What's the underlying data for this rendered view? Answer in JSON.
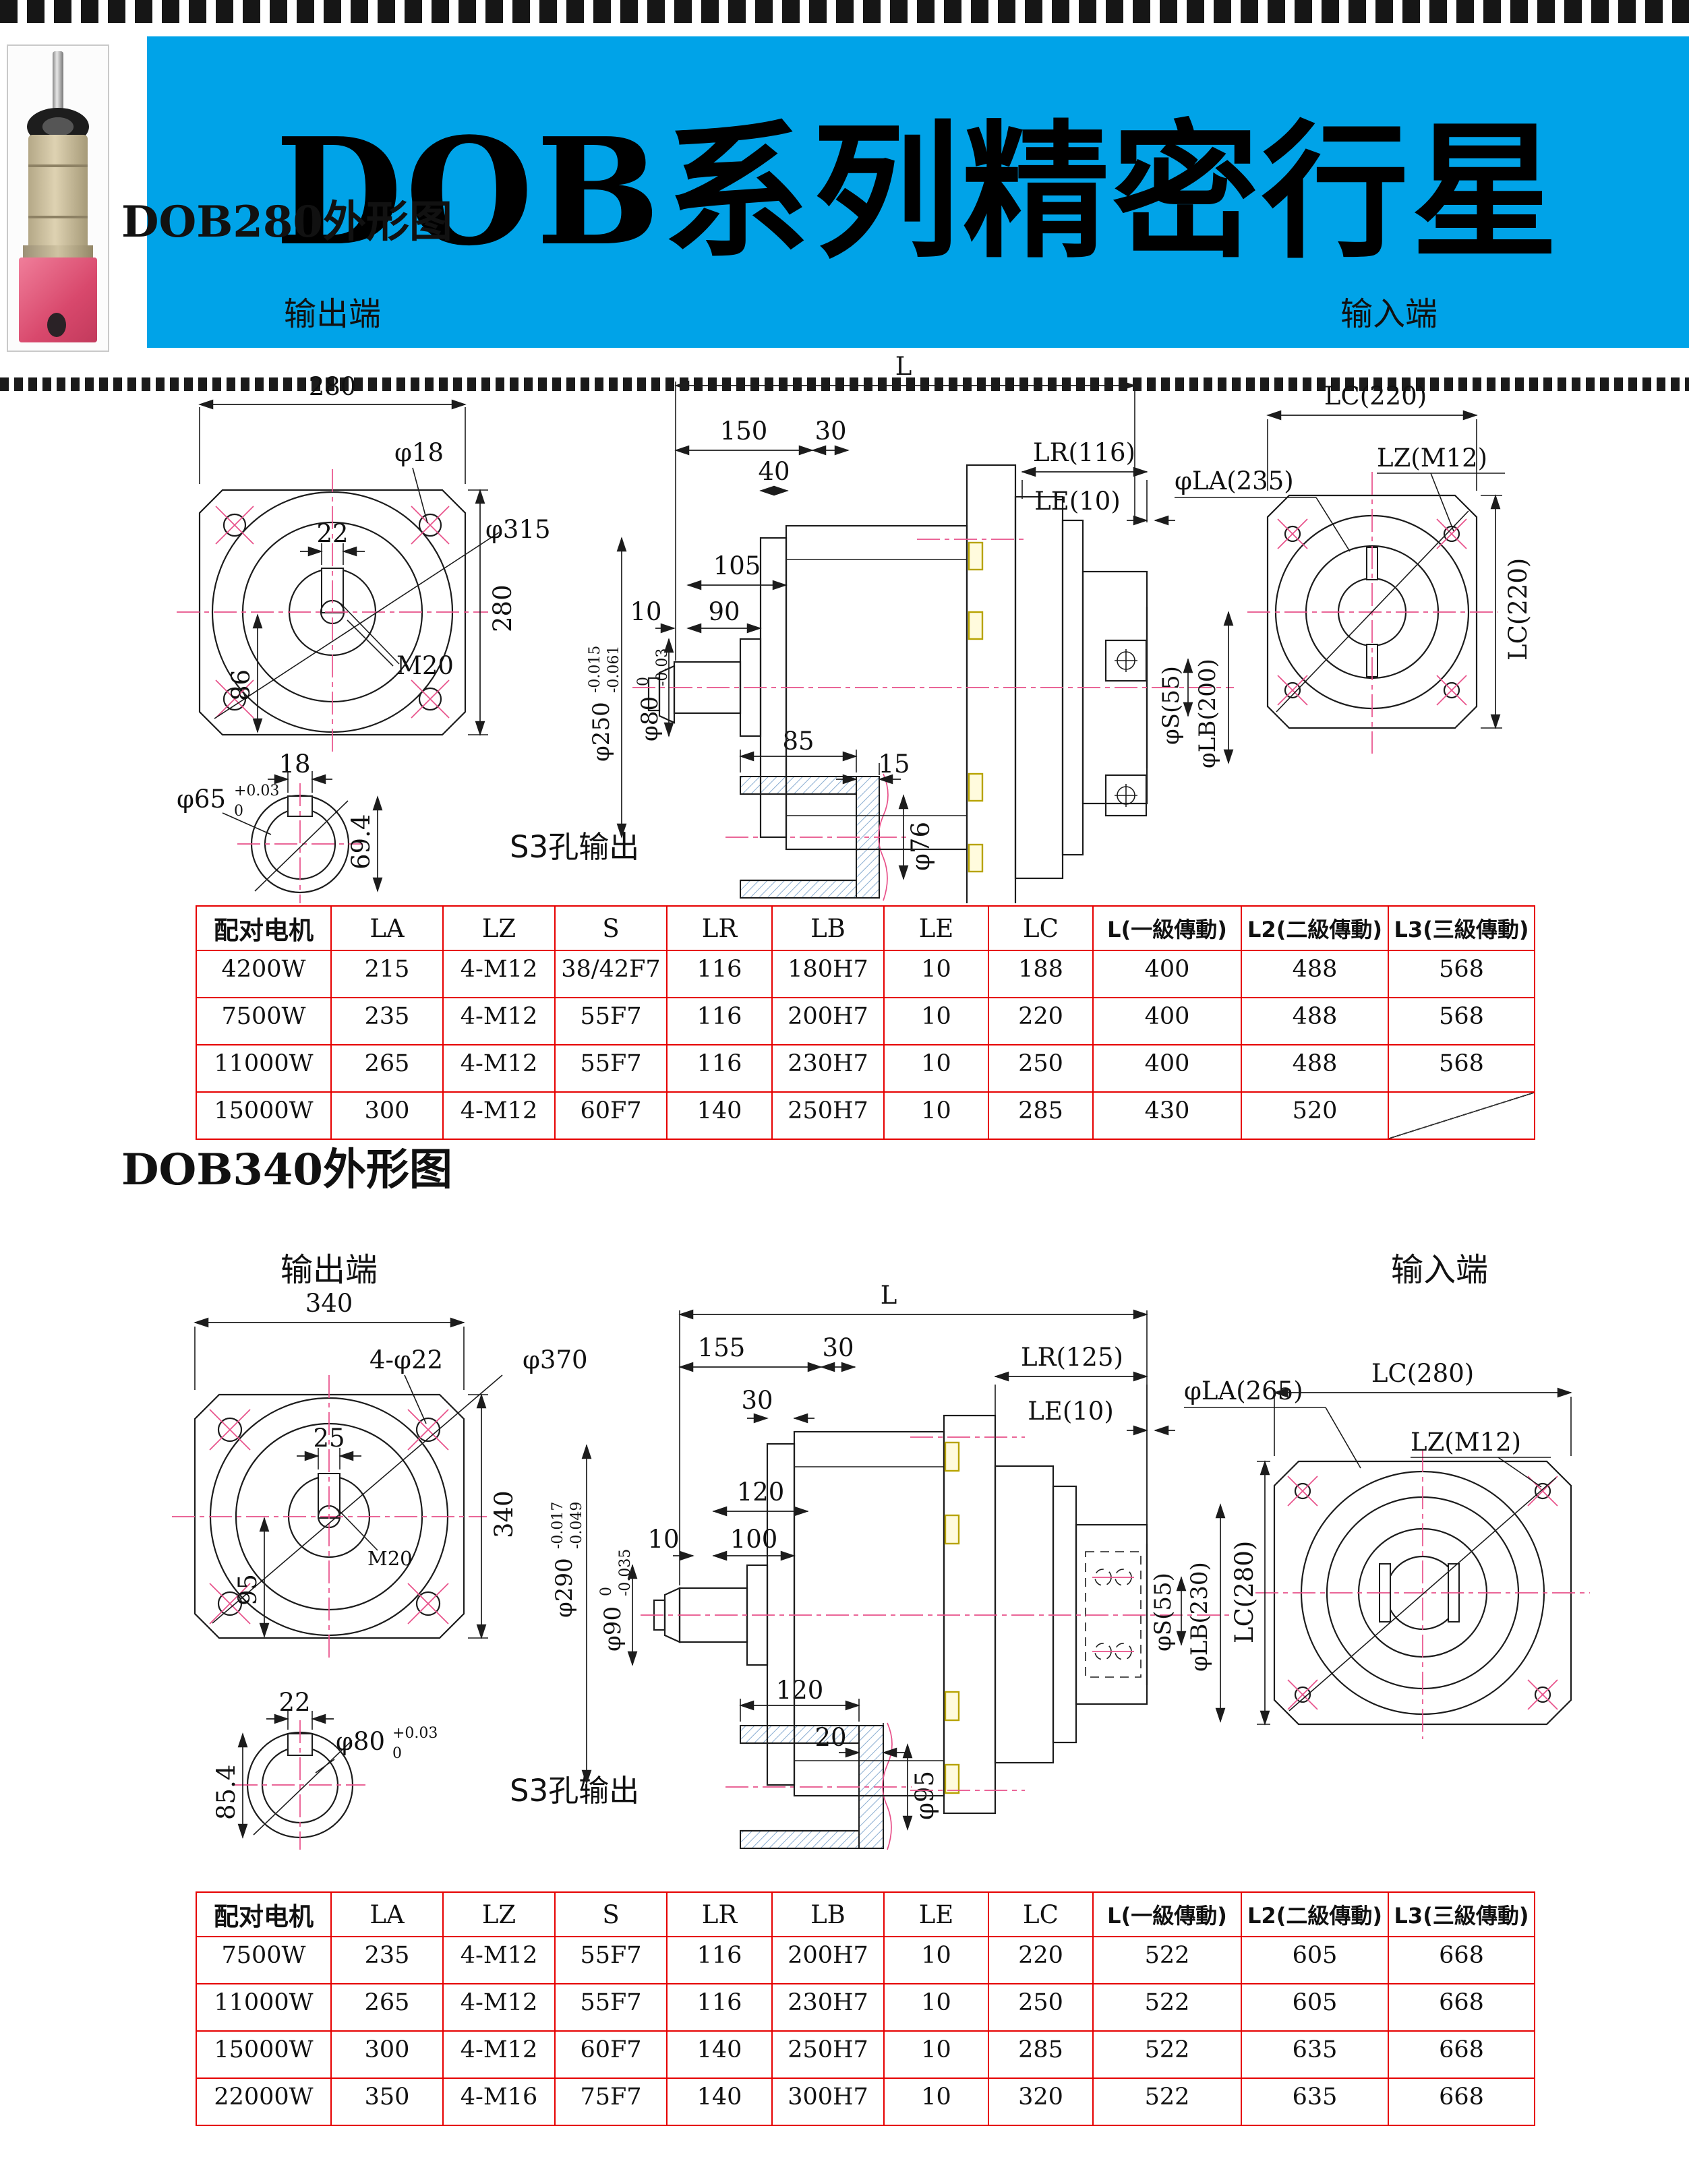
{
  "header": {
    "title": "DOB系列精密行星",
    "banner_color": "#00a3e8",
    "photo_icon": "planetary-gearbox-photo"
  },
  "labels": {
    "out": "输出端",
    "inp": "输入端",
    "s3": "S3孔输出"
  },
  "sections": [
    {
      "title": "DOB280外形图",
      "out": {
        "w": "280",
        "hole": "φ18",
        "bc": "φ315",
        "kw": "22",
        "kh": "86",
        "thread": "M20"
      },
      "side": {
        "L": "L",
        "a": "150",
        "b": "30",
        "c": "40",
        "d": "105",
        "e": "10",
        "f": "90",
        "lr": "LR(116)",
        "le": "LE(10)",
        "la": "φLA(235)",
        "od": "φ250",
        "od_t1": "-0.015",
        "od_t2": "-0.061",
        "sh": "φ80",
        "sh_t1": "0",
        "sh_t2": "-0.03",
        "s": "φS(55)",
        "lb": "φLB(200)"
      },
      "inp": {
        "lc_top": "LC(220)",
        "lz": "LZ(M12)",
        "lc_side": "LC(220)"
      },
      "shaft": {
        "d": "φ65",
        "t1": "+0.03",
        "t2": "0",
        "kw": "18",
        "kh": "69.4"
      },
      "s3d": {
        "a": "85",
        "b": "15",
        "d": "φ76"
      }
    },
    {
      "title": "DOB340外形图",
      "out": {
        "w": "340",
        "hole": "4-φ22",
        "bc": "φ370",
        "kw": "25",
        "kh": "95",
        "thread": "M20"
      },
      "side": {
        "L": "L",
        "a": "155",
        "b": "30",
        "c": "30",
        "d": "120",
        "e": "10",
        "f": "100",
        "lr": "LR(125)",
        "le": "LE(10)",
        "la": "φLA(265)",
        "od": "φ290",
        "od_t1": "-0.017",
        "od_t2": "-0.049",
        "sh": "φ90",
        "sh_t1": "0",
        "sh_t2": "-0.035",
        "s": "φS(55)",
        "lb": "φLB(230)"
      },
      "inp": {
        "lc_top": "LC(280)",
        "lz": "LZ(M12)",
        "lc_side": "LC(280)"
      },
      "shaft": {
        "d": "φ80",
        "t1": "+0.03",
        "t2": "0",
        "kw": "22",
        "kh": "85.4"
      },
      "s3d": {
        "a": "120",
        "b": "20",
        "d": "φ95"
      }
    }
  ],
  "tables": [
    {
      "headers": [
        "配对电机",
        "LA",
        "LZ",
        "S",
        "LR",
        "LB",
        "LE",
        "LC",
        "L(一級傳動)",
        "L2(二級傳動)",
        "L3(三級傳動)"
      ],
      "rows": [
        [
          "4200W",
          "215",
          "4-M12",
          "38/42F7",
          "116",
          "180H7",
          "10",
          "188",
          "400",
          "488",
          "568"
        ],
        [
          "7500W",
          "235",
          "4-M12",
          "55F7",
          "116",
          "200H7",
          "10",
          "220",
          "400",
          "488",
          "568"
        ],
        [
          "11000W",
          "265",
          "4-M12",
          "55F7",
          "116",
          "230H7",
          "10",
          "250",
          "400",
          "488",
          "568"
        ],
        [
          "15000W",
          "300",
          "4-M12",
          "60F7",
          "140",
          "250H7",
          "10",
          "285",
          "430",
          "520",
          ""
        ]
      ]
    },
    {
      "headers": [
        "配对电机",
        "LA",
        "LZ",
        "S",
        "LR",
        "LB",
        "LE",
        "LC",
        "L(一級傳動)",
        "L2(二級傳動)",
        "L3(三級傳動)"
      ],
      "rows": [
        [
          "7500W",
          "235",
          "4-M12",
          "55F7",
          "116",
          "200H7",
          "10",
          "220",
          "522",
          "605",
          "668"
        ],
        [
          "11000W",
          "265",
          "4-M12",
          "55F7",
          "116",
          "230H7",
          "10",
          "250",
          "522",
          "605",
          "668"
        ],
        [
          "15000W",
          "300",
          "4-M12",
          "60F7",
          "140",
          "250H7",
          "10",
          "285",
          "522",
          "635",
          "668"
        ],
        [
          "22000W",
          "350",
          "4-M16",
          "75F7",
          "140",
          "300H7",
          "10",
          "320",
          "522",
          "635",
          "668"
        ]
      ]
    }
  ]
}
